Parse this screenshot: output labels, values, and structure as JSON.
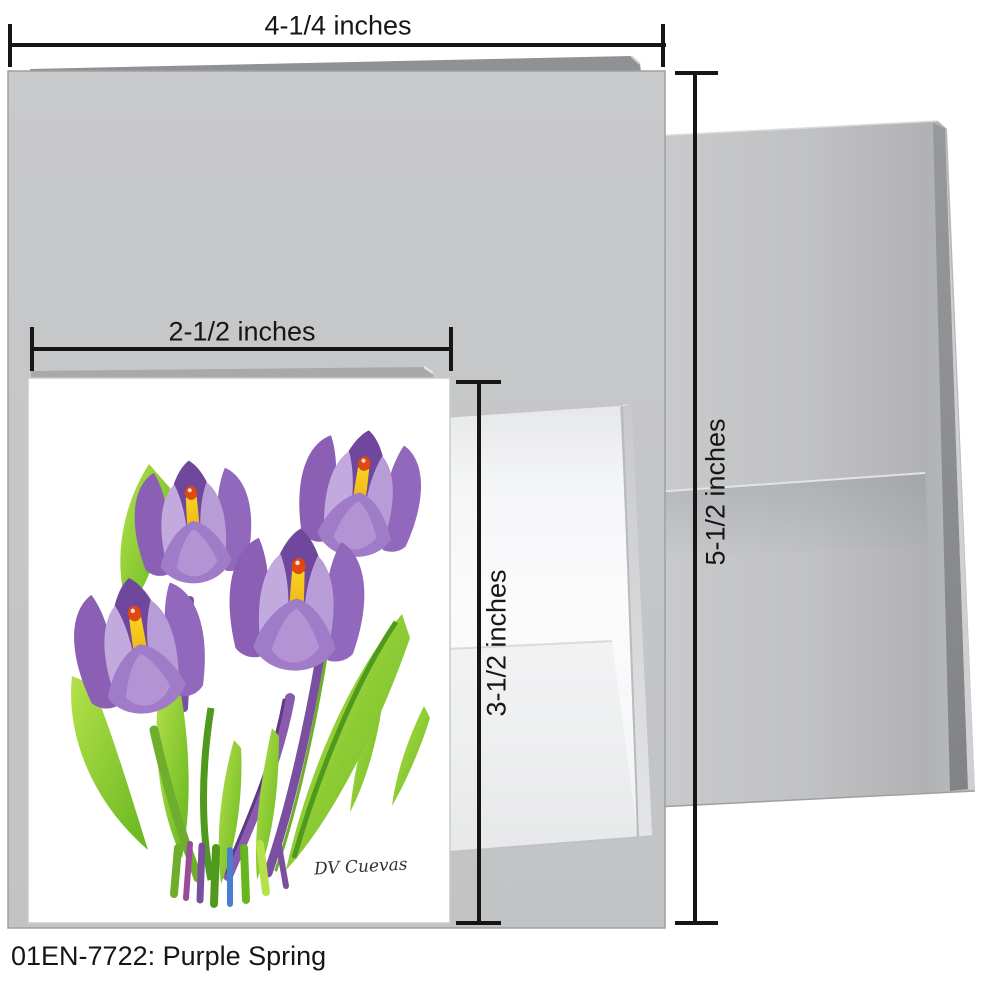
{
  "caption": "01EN-7722: Purple Spring",
  "large_card": {
    "width_label": "4-1/4 inches",
    "height_label": "5-1/2 inches"
  },
  "small_card": {
    "width_label": "2-1/2 inches",
    "height_label": "3-1/2 inches"
  },
  "artwork": {
    "signature": "DV Cuevas"
  },
  "colors": {
    "line": "#161616",
    "label_text": "#161616",
    "card_front": "#c6c7c9",
    "card_back": "#8f9194",
    "card_border": "#9da0a2",
    "envelope_large": "#c0c1c3",
    "envelope_large_shadow": "#97989a",
    "envelope_small": "#fbfbfc",
    "small_card_face": "#ffffff",
    "small_card_border": "#c9cacc",
    "petal_dark": "#6f479c",
    "petal_mid": "#8a5fb4",
    "petal_mid2": "#9168bb",
    "petal_light": "#c2a9de",
    "petal_light2": "#b79cd7",
    "petal_front": "#a07cc8",
    "petal_front_hl": "#bb9ad8",
    "pistil_top": "#f6d31f",
    "pistil_bottom": "#eda211",
    "pistil_tip": "#e2470f",
    "leaf_light": "#b5e14b",
    "leaf_main": "#66b61f",
    "leaf_dark": "#4f9a1c",
    "stem_purple": "#7b4fa0",
    "stem_violet": "#8a5aae",
    "stem_green": "#6fae2c",
    "base_blue": "#4a7fd0",
    "base_magenta": "#9a4a9a"
  }
}
